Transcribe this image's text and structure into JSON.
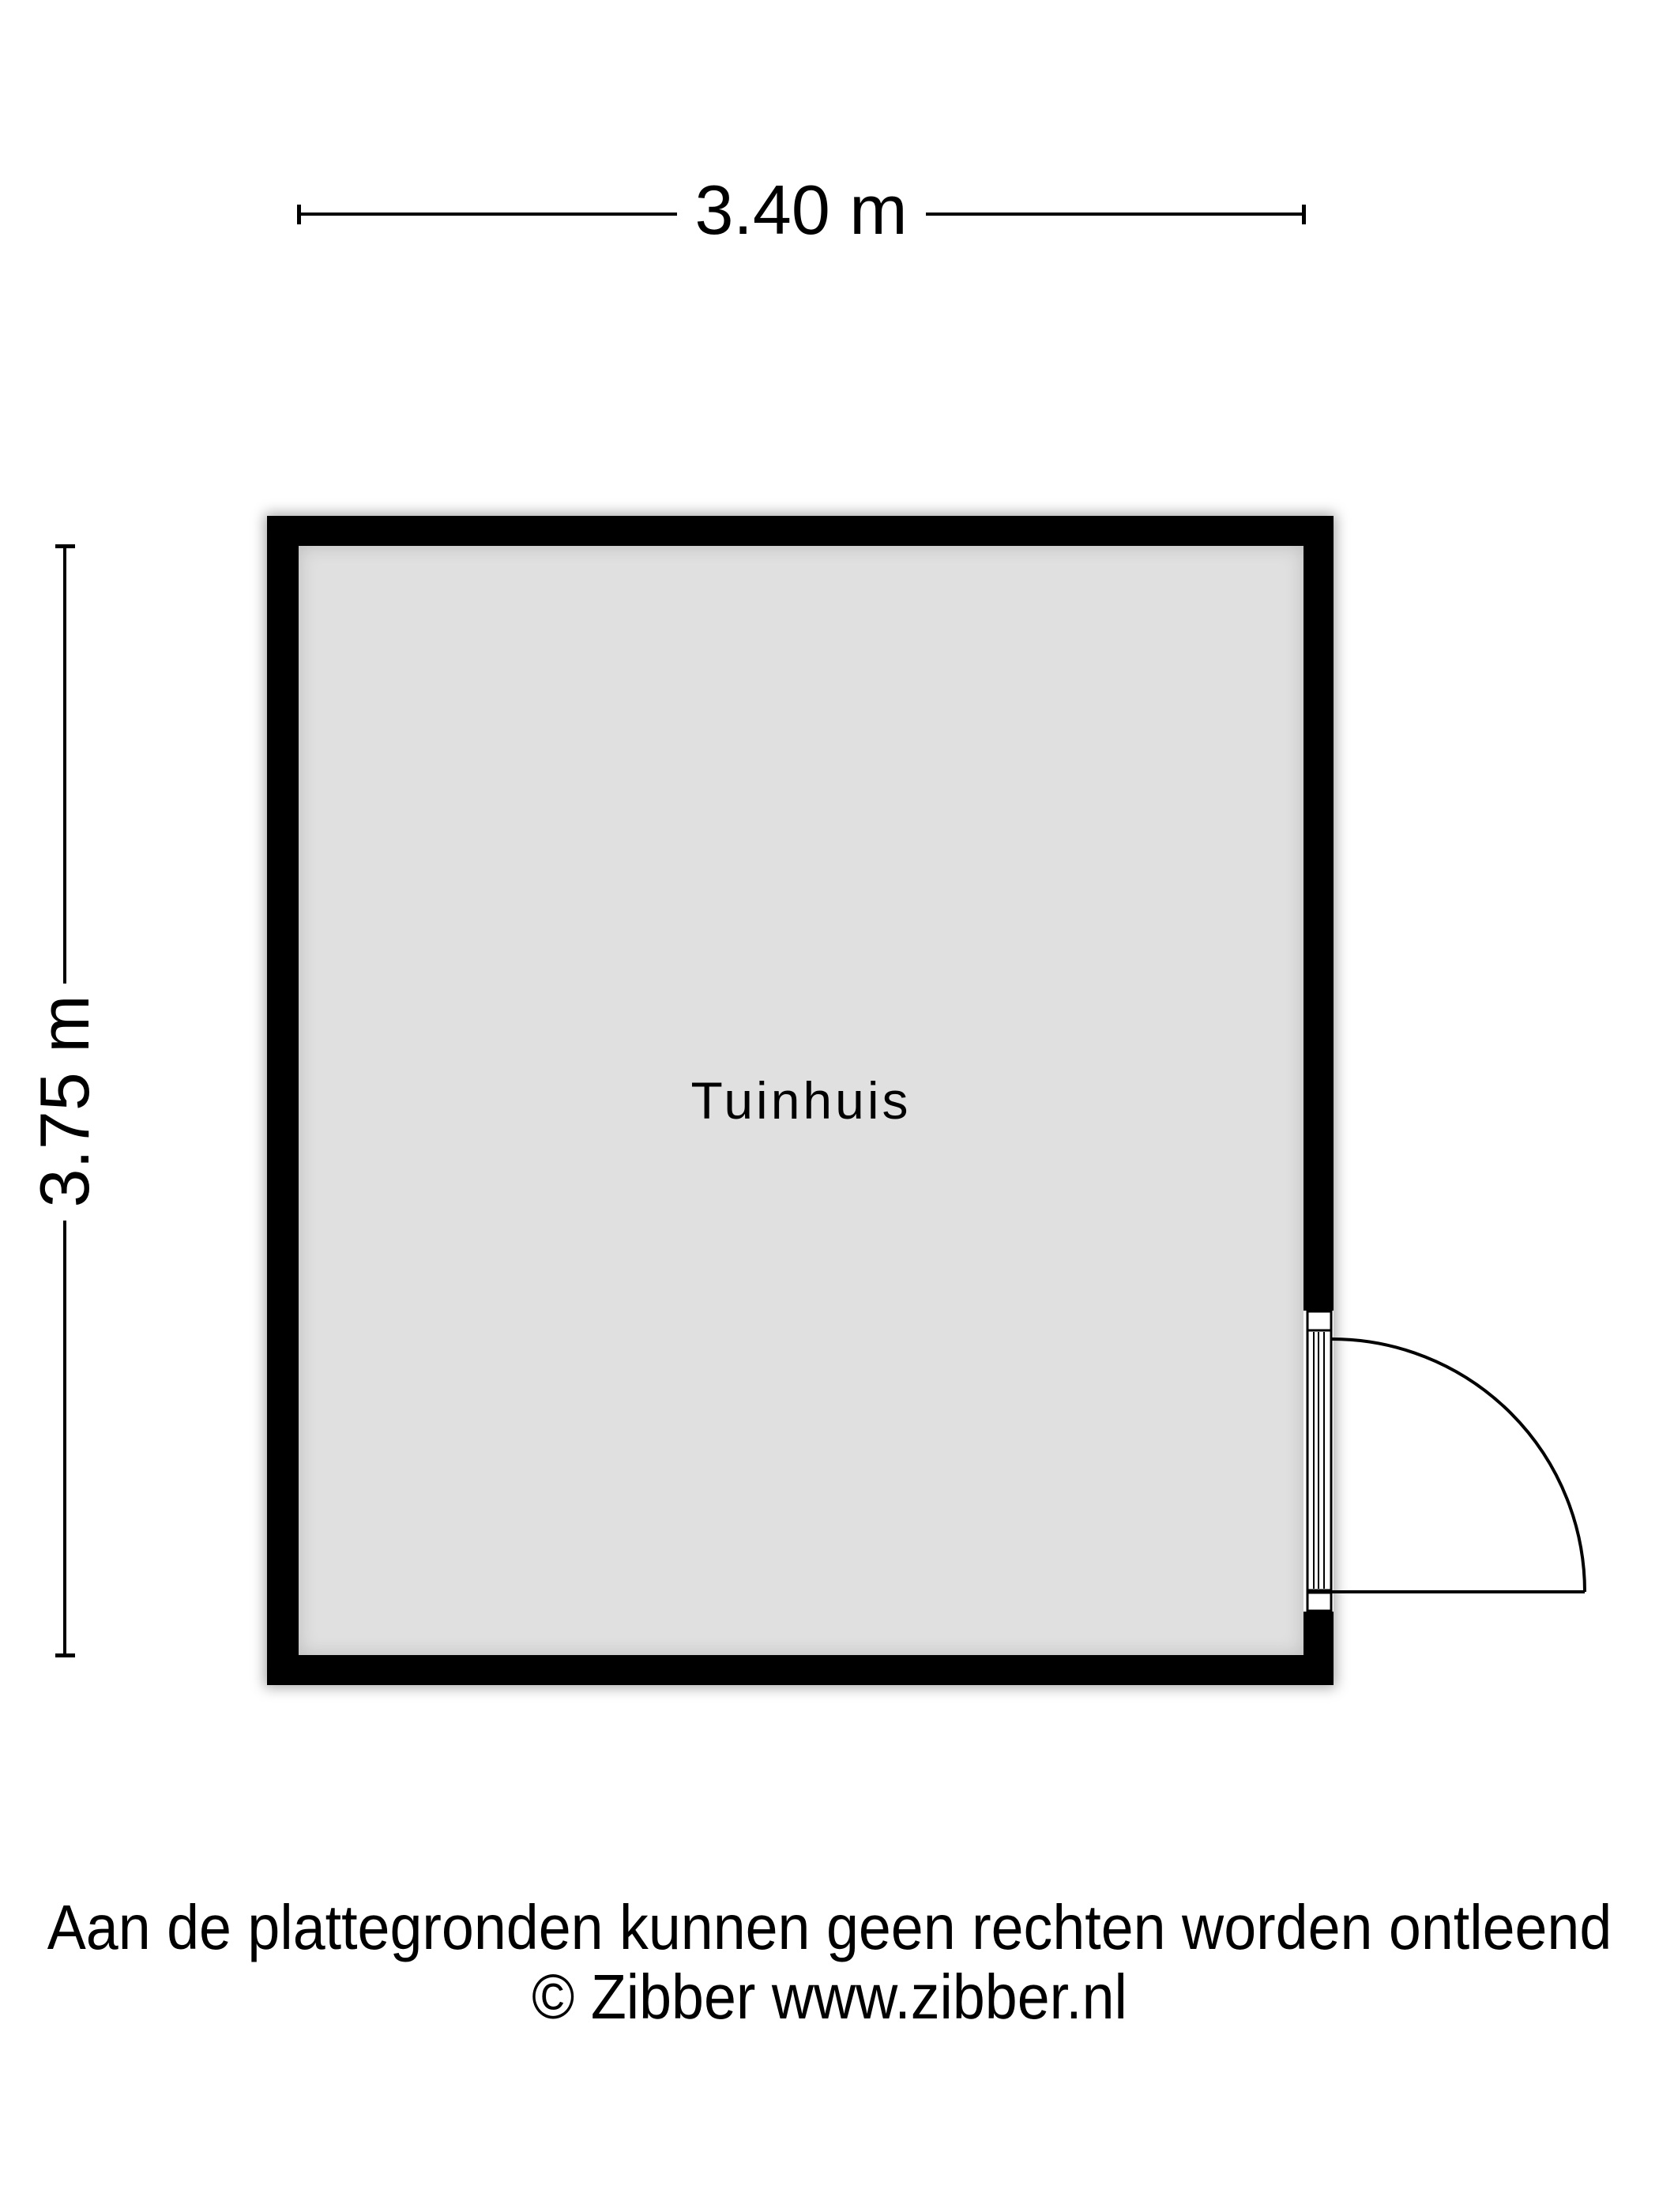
{
  "floorplan": {
    "room": {
      "label": "Tuinhuis"
    },
    "dimensions": {
      "width": {
        "label": "3.40 m"
      },
      "height": {
        "label": "3.75 m"
      }
    },
    "door": {
      "type": "single-swing",
      "wall": "right",
      "swing": "outward"
    },
    "colors": {
      "wall": "#000000",
      "floor": "#e0e0e0",
      "background": "#ffffff"
    }
  },
  "footer": {
    "line1": "Aan de plattegronden kunnen geen rechten worden ontleend",
    "line2": "© Zibber www.zibber.nl"
  }
}
